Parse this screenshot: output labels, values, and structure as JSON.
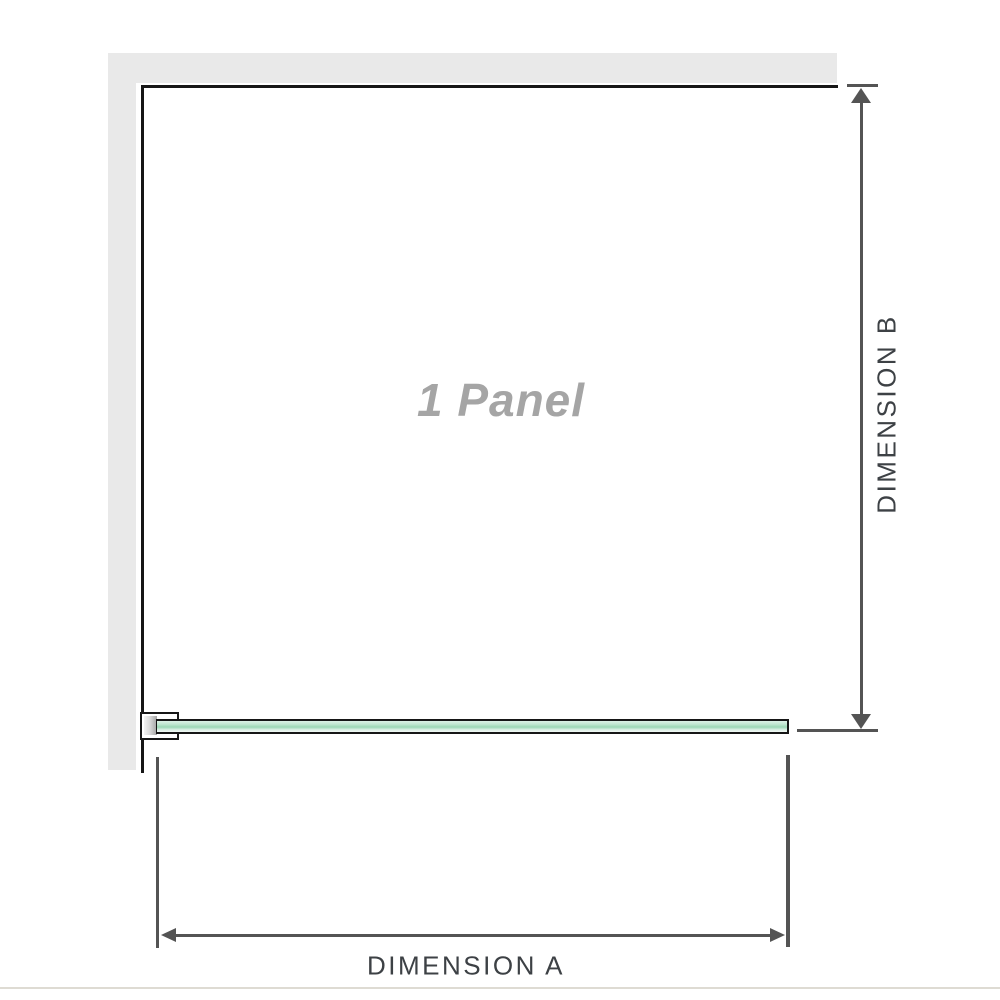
{
  "colors": {
    "wall-gray": "#e9e9e9",
    "frame-black": "#161616",
    "arrow-gray": "#545454",
    "label-dark": "#3d4145",
    "panel-text-gray": "#a5a5a5",
    "glass-green-light": "#ddf0e6",
    "glass-green-mid": "#9cd7b5",
    "glass-green-pale": "#f0f8f4",
    "divider-beige": "#dedbd3"
  },
  "diagram": {
    "panel_label": "1 Panel",
    "dimensions": {
      "a": {
        "label": "DIMENSION A",
        "orientation": "horizontal"
      },
      "b": {
        "label": "DIMENSION B",
        "orientation": "vertical"
      }
    }
  }
}
